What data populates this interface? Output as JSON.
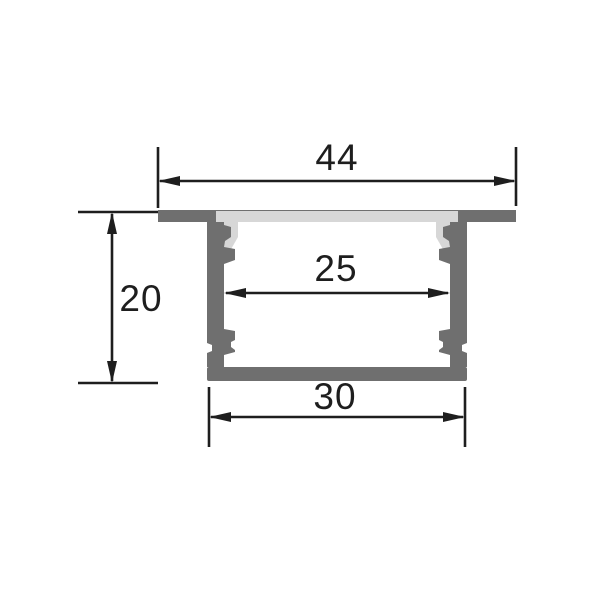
{
  "drawing": {
    "title": "LED aluminium profile cross-section dimension drawing",
    "labels": {
      "top_width": "44",
      "inner_width": "25",
      "height": "20",
      "bottom_width": "30"
    }
  },
  "colors": {
    "aluminum": "#6f6f6f",
    "diffuser": "#d7d7d7",
    "line": "#1e1e1e",
    "background": "#ffffff"
  }
}
